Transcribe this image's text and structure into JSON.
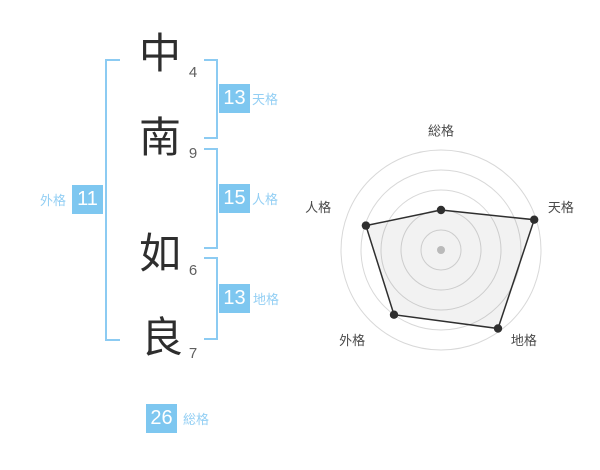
{
  "colors": {
    "accent_blue": "#7EC7F0",
    "label_blue": "#93CFF4",
    "bracket_blue": "#8CCBF2",
    "text_dark": "#2e2e2e",
    "stroke_number_gray": "#5f5f5f",
    "ring_gray": "#D8D8D8",
    "polygon_line": "#2F2F2F",
    "polygon_fill": "rgba(0,0,0,0.05)",
    "center_dot_gray": "#C5C5C5",
    "chart_label_gray": "#4A4A4A"
  },
  "name_analysis": {
    "characters": [
      {
        "char": "中",
        "strokes": "4"
      },
      {
        "char": "南",
        "strokes": "9"
      },
      {
        "char": "如",
        "strokes": "6"
      },
      {
        "char": "良",
        "strokes": "7"
      }
    ],
    "scores": {
      "tenkaku": {
        "value": "13",
        "label": "天格"
      },
      "jinkaku": {
        "value": "15",
        "label": "人格"
      },
      "chikaku": {
        "value": "13",
        "label": "地格"
      },
      "gaikaku": {
        "value": "11",
        "label": "外格"
      },
      "soukaku": {
        "value": "26",
        "label": "総格"
      }
    }
  },
  "chart_data": {
    "type": "radar",
    "title": "",
    "categories": [
      "総格",
      "天格",
      "地格",
      "外格",
      "人格"
    ],
    "values": [
      40,
      98,
      97,
      80,
      79
    ],
    "max": 100,
    "rings": 5,
    "start_angle_deg": -90,
    "direction": "clockwise",
    "grid": "circular",
    "legend": "none"
  }
}
